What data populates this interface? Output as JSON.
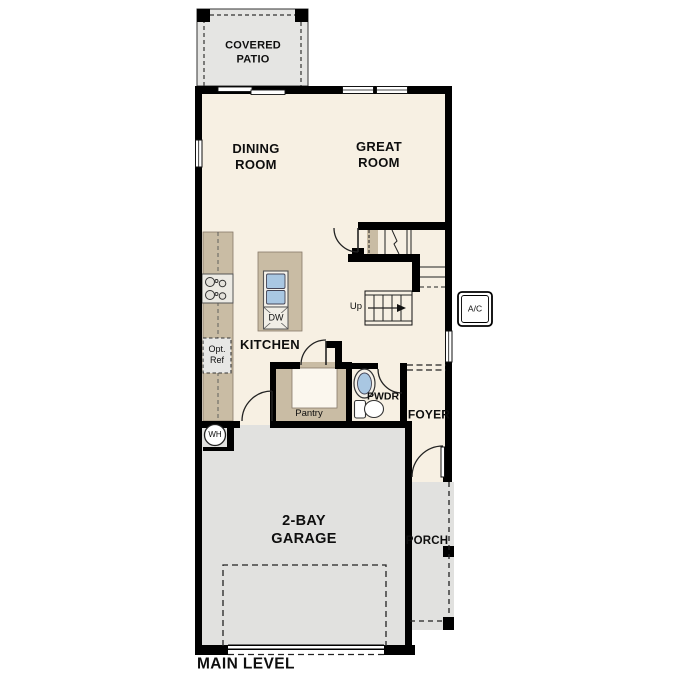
{
  "plan": {
    "level_label": "MAIN LEVEL"
  },
  "rooms": {
    "covered_patio": {
      "line1": "COVERED",
      "line2": "PATIO"
    },
    "dining_room": {
      "line1": "DINING",
      "line2": "ROOM"
    },
    "great_room": {
      "line1": "GREAT",
      "line2": "ROOM"
    },
    "kitchen": {
      "label": "KITCHEN"
    },
    "pantry": {
      "label": "Pantry"
    },
    "powder_room": {
      "label": "PWDR"
    },
    "foyer": {
      "label": "FOYER"
    },
    "garage": {
      "line1": "2-BAY",
      "line2": "GARAGE"
    },
    "porch": {
      "label": "PORCH"
    }
  },
  "fixtures": {
    "ac_unit": {
      "label": "A/C"
    },
    "water_heater": {
      "label": "WH"
    },
    "dishwasher": {
      "label": "DW"
    },
    "optional_refrigerator": {
      "line1": "Opt.",
      "line2": "Ref"
    },
    "stairs": {
      "label": "Up"
    }
  },
  "colors": {
    "floor": "#f7f0e3",
    "garage_floor": "#e1e1df",
    "patio_floor": "#e5e5e3",
    "cabinetry_tan": "#c9bca4",
    "fixture_blue": "#a9c7e2",
    "wall": "#000000",
    "background": "#ffffff"
  }
}
